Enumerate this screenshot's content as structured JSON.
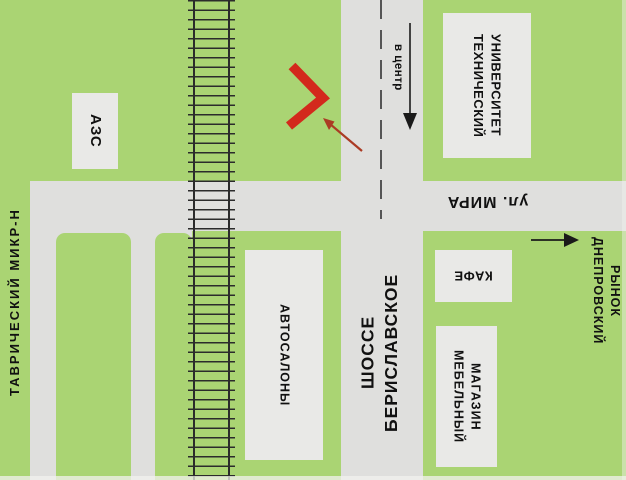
{
  "map": {
    "landmarks": {
      "gas_station": "АЗС",
      "university": "ТЕХНИЧЕСКИЙ\nУНИВЕРСИТЕТ",
      "car_dealers": "АВТОСАЛОНЫ",
      "cafe": "КАФЕ",
      "furniture_store": "МЕБЕЛЬНЫЙ\nМАГАЗИН",
      "market": "ДНЕПРОВСКИЙ\nРЫНОК"
    },
    "streets": {
      "highway": "БЕРИСЛАВСКОЕ ШОССЕ",
      "mira_street": "ул. МИРА",
      "district": "ТАВРИЧЕСКИЙ МИКР-Н"
    },
    "directions": {
      "to_center": "в центр"
    },
    "icons": {
      "location_marker": "red-chevron",
      "pointer": "red-arrow",
      "to_center_arrow": "down-arrow",
      "market_arrow": "right-arrow"
    },
    "colors": {
      "background": "#aad473",
      "road": "#dfdfdd",
      "building_box": "#e9e9e7",
      "railroad": "#2b2b2b",
      "text": "#111111",
      "marker_red": "#d3291c",
      "pointer_red": "#ab3b24",
      "arrow_black": "#1a1a1a",
      "centerline": "#555555"
    }
  }
}
